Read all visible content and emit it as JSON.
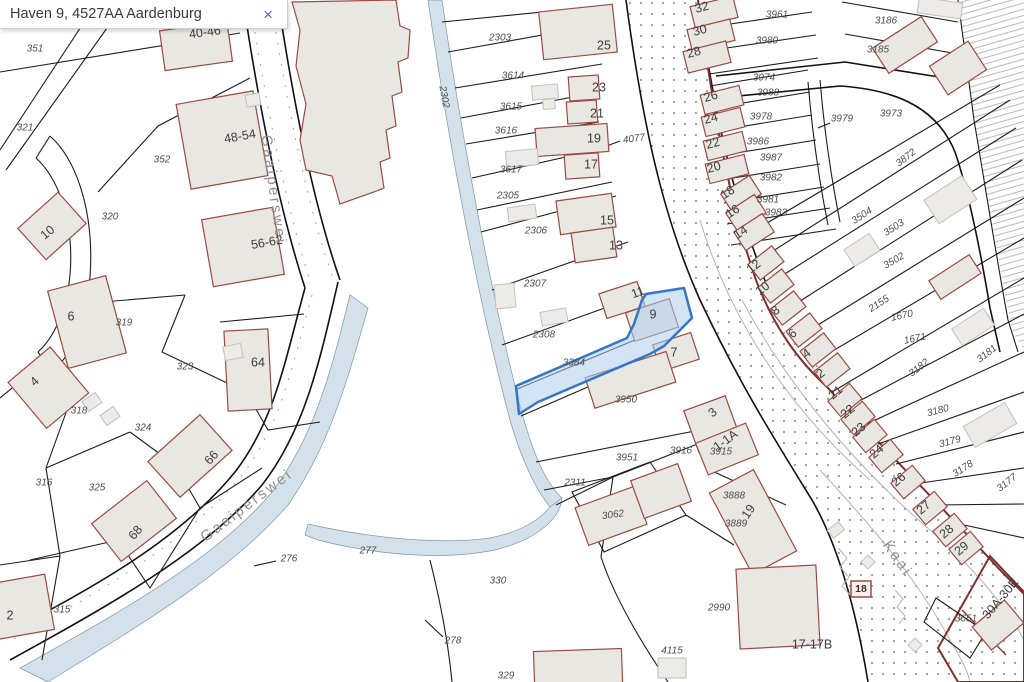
{
  "search": {
    "value": "Haven 9, 4527AA Aardenburg",
    "close_label": "×"
  },
  "map": {
    "highlight": {
      "parcel": "3384",
      "house_number": "9",
      "fill": "#aecdf0",
      "stroke": "#3576c8"
    },
    "labels": {
      "streets": [
        {
          "t": "Gaaiperswei",
          "x": 273,
          "y": 190,
          "r": 82
        },
        {
          "t": "Gaaiperswei",
          "x": 247,
          "y": 506,
          "r": -37
        },
        {
          "t": "Kaai",
          "x": 897,
          "y": 559,
          "r": 55
        }
      ],
      "boxed": [
        {
          "t": "18",
          "x": 861,
          "y": 589
        }
      ],
      "parcels": [
        {
          "t": "351",
          "x": 35,
          "y": 49
        },
        {
          "t": "321",
          "x": 25,
          "y": 128
        },
        {
          "t": "352",
          "x": 162,
          "y": 160
        },
        {
          "t": "320",
          "x": 110,
          "y": 217
        },
        {
          "t": "319",
          "x": 124,
          "y": 323
        },
        {
          "t": "323",
          "x": 185,
          "y": 367
        },
        {
          "t": "318",
          "x": 79,
          "y": 411
        },
        {
          "t": "324",
          "x": 143,
          "y": 428
        },
        {
          "t": "316",
          "x": 44,
          "y": 483
        },
        {
          "t": "325",
          "x": 97,
          "y": 488
        },
        {
          "t": "315",
          "x": 62,
          "y": 610
        },
        {
          "t": "276",
          "x": 289,
          "y": 559
        },
        {
          "t": "277",
          "x": 368,
          "y": 551
        },
        {
          "t": "330",
          "x": 498,
          "y": 581
        },
        {
          "t": "278",
          "x": 453,
          "y": 641
        },
        {
          "t": "329",
          "x": 506,
          "y": 676
        },
        {
          "t": "2302",
          "x": 444,
          "y": 97,
          "r": 80
        },
        {
          "t": "2303",
          "x": 500,
          "y": 38
        },
        {
          "t": "3614",
          "x": 513,
          "y": 76
        },
        {
          "t": "3615",
          "x": 511,
          "y": 107
        },
        {
          "t": "3616",
          "x": 506,
          "y": 131
        },
        {
          "t": "3617",
          "x": 511,
          "y": 170
        },
        {
          "t": "2305",
          "x": 508,
          "y": 196
        },
        {
          "t": "2306",
          "x": 536,
          "y": 231
        },
        {
          "t": "2307",
          "x": 535,
          "y": 284
        },
        {
          "t": "2308",
          "x": 544,
          "y": 335
        },
        {
          "t": "3384",
          "x": 574,
          "y": 363
        },
        {
          "t": "3950",
          "x": 626,
          "y": 400
        },
        {
          "t": "3951",
          "x": 627,
          "y": 458
        },
        {
          "t": "2311",
          "x": 575,
          "y": 483
        },
        {
          "t": "3916",
          "x": 681,
          "y": 451
        },
        {
          "t": "3915",
          "x": 721,
          "y": 452
        },
        {
          "t": "3062",
          "x": 613,
          "y": 515,
          "r": -8
        },
        {
          "t": "3888",
          "x": 734,
          "y": 496
        },
        {
          "t": "3889",
          "x": 736,
          "y": 524
        },
        {
          "t": "2990",
          "x": 719,
          "y": 608
        },
        {
          "t": "4115",
          "x": 672,
          "y": 651
        },
        {
          "t": "4077",
          "x": 634,
          "y": 139,
          "r": -8
        },
        {
          "t": "3961",
          "x": 777,
          "y": 15
        },
        {
          "t": "3980",
          "x": 767,
          "y": 41
        },
        {
          "t": "3974",
          "x": 764,
          "y": 78
        },
        {
          "t": "3988",
          "x": 768,
          "y": 93
        },
        {
          "t": "3978",
          "x": 761,
          "y": 117
        },
        {
          "t": "3986",
          "x": 758,
          "y": 142
        },
        {
          "t": "3987",
          "x": 771,
          "y": 158
        },
        {
          "t": "3982",
          "x": 771,
          "y": 178
        },
        {
          "t": "3981",
          "x": 768,
          "y": 200
        },
        {
          "t": "3983",
          "x": 776,
          "y": 213
        },
        {
          "t": "3979",
          "x": 842,
          "y": 119
        },
        {
          "t": "3186",
          "x": 886,
          "y": 21
        },
        {
          "t": "3185",
          "x": 878,
          "y": 50
        },
        {
          "t": "3973",
          "x": 891,
          "y": 114
        },
        {
          "t": "3872",
          "x": 906,
          "y": 158,
          "r": -38
        },
        {
          "t": "3504",
          "x": 862,
          "y": 216,
          "r": -33
        },
        {
          "t": "3503",
          "x": 894,
          "y": 228,
          "r": -33
        },
        {
          "t": "3502",
          "x": 894,
          "y": 261,
          "r": -30
        },
        {
          "t": "2155",
          "x": 879,
          "y": 304,
          "r": -33
        },
        {
          "t": "1670",
          "x": 902,
          "y": 316,
          "r": -12
        },
        {
          "t": "1671",
          "x": 915,
          "y": 339,
          "r": -12
        },
        {
          "t": "3182",
          "x": 919,
          "y": 368,
          "r": -38
        },
        {
          "t": "3181",
          "x": 987,
          "y": 354,
          "r": -38
        },
        {
          "t": "3180",
          "x": 938,
          "y": 411,
          "r": -15
        },
        {
          "t": "3179",
          "x": 950,
          "y": 442,
          "r": -15
        },
        {
          "t": "3178",
          "x": 963,
          "y": 469,
          "r": -33
        },
        {
          "t": "3177",
          "x": 1007,
          "y": 483,
          "r": -38
        },
        {
          "t": "3651",
          "x": 966,
          "y": 619
        }
      ],
      "houses": [
        {
          "t": "40-46",
          "x": 205,
          "y": 33,
          "r": -8
        },
        {
          "t": "48-54",
          "x": 240,
          "y": 137,
          "r": -10
        },
        {
          "t": "56-62",
          "x": 267,
          "y": 243,
          "r": -10
        },
        {
          "t": "10",
          "x": 48,
          "y": 233,
          "r": -40
        },
        {
          "t": "6",
          "x": 71,
          "y": 317
        },
        {
          "t": "4",
          "x": 35,
          "y": 382,
          "r": -42
        },
        {
          "t": "64",
          "x": 258,
          "y": 363
        },
        {
          "t": "66",
          "x": 212,
          "y": 458,
          "r": -48
        },
        {
          "t": "68",
          "x": 136,
          "y": 533,
          "r": -50
        },
        {
          "t": "2",
          "x": 10,
          "y": 616
        },
        {
          "t": "25",
          "x": 604,
          "y": 46
        },
        {
          "t": "23",
          "x": 599,
          "y": 88
        },
        {
          "t": "21",
          "x": 597,
          "y": 114
        },
        {
          "t": "19",
          "x": 594,
          "y": 139
        },
        {
          "t": "17",
          "x": 591,
          "y": 165
        },
        {
          "t": "15",
          "x": 607,
          "y": 221
        },
        {
          "t": "13",
          "x": 616,
          "y": 246
        },
        {
          "t": "11",
          "x": 638,
          "y": 293,
          "r": -20
        },
        {
          "t": "9",
          "x": 653,
          "y": 315
        },
        {
          "t": "7",
          "x": 674,
          "y": 353
        },
        {
          "t": "3",
          "x": 713,
          "y": 413,
          "r": -40
        },
        {
          "t": "1-1A",
          "x": 726,
          "y": 441,
          "r": -36
        },
        {
          "t": "19",
          "x": 749,
          "y": 512,
          "r": -55
        },
        {
          "t": "32",
          "x": 702,
          "y": 8,
          "r": -15
        },
        {
          "t": "30",
          "x": 700,
          "y": 31,
          "r": -15
        },
        {
          "t": "28",
          "x": 694,
          "y": 53,
          "r": -15
        },
        {
          "t": "26",
          "x": 711,
          "y": 97,
          "r": -15
        },
        {
          "t": "24",
          "x": 711,
          "y": 119,
          "r": -15
        },
        {
          "t": "22",
          "x": 713,
          "y": 144,
          "r": -15
        },
        {
          "t": "20",
          "x": 714,
          "y": 168,
          "r": -15
        },
        {
          "t": "18",
          "x": 728,
          "y": 193,
          "r": -33
        },
        {
          "t": "16",
          "x": 733,
          "y": 212,
          "r": -33
        },
        {
          "t": "14",
          "x": 741,
          "y": 233,
          "r": -33
        },
        {
          "t": "12",
          "x": 754,
          "y": 267,
          "r": -38
        },
        {
          "t": "10",
          "x": 763,
          "y": 289,
          "r": -38
        },
        {
          "t": "8",
          "x": 776,
          "y": 311,
          "r": -38
        },
        {
          "t": "6",
          "x": 793,
          "y": 334,
          "r": -38
        },
        {
          "t": "4",
          "x": 807,
          "y": 354,
          "r": -38
        },
        {
          "t": "2",
          "x": 821,
          "y": 374,
          "r": -38
        },
        {
          "t": "21",
          "x": 836,
          "y": 393,
          "r": -40
        },
        {
          "t": "22",
          "x": 848,
          "y": 412,
          "r": -40
        },
        {
          "t": "23",
          "x": 859,
          "y": 430,
          "r": -40
        },
        {
          "t": "24",
          "x": 877,
          "y": 452,
          "r": -40
        },
        {
          "t": "26",
          "x": 899,
          "y": 480,
          "r": -40
        },
        {
          "t": "27",
          "x": 924,
          "y": 508,
          "r": -40
        },
        {
          "t": "28",
          "x": 947,
          "y": 532,
          "r": -40
        },
        {
          "t": "29",
          "x": 962,
          "y": 549,
          "r": -40
        },
        {
          "t": "30A-30E",
          "x": 1001,
          "y": 599,
          "r": -50
        },
        {
          "t": "17-17B",
          "x": 812,
          "y": 645
        }
      ]
    }
  }
}
